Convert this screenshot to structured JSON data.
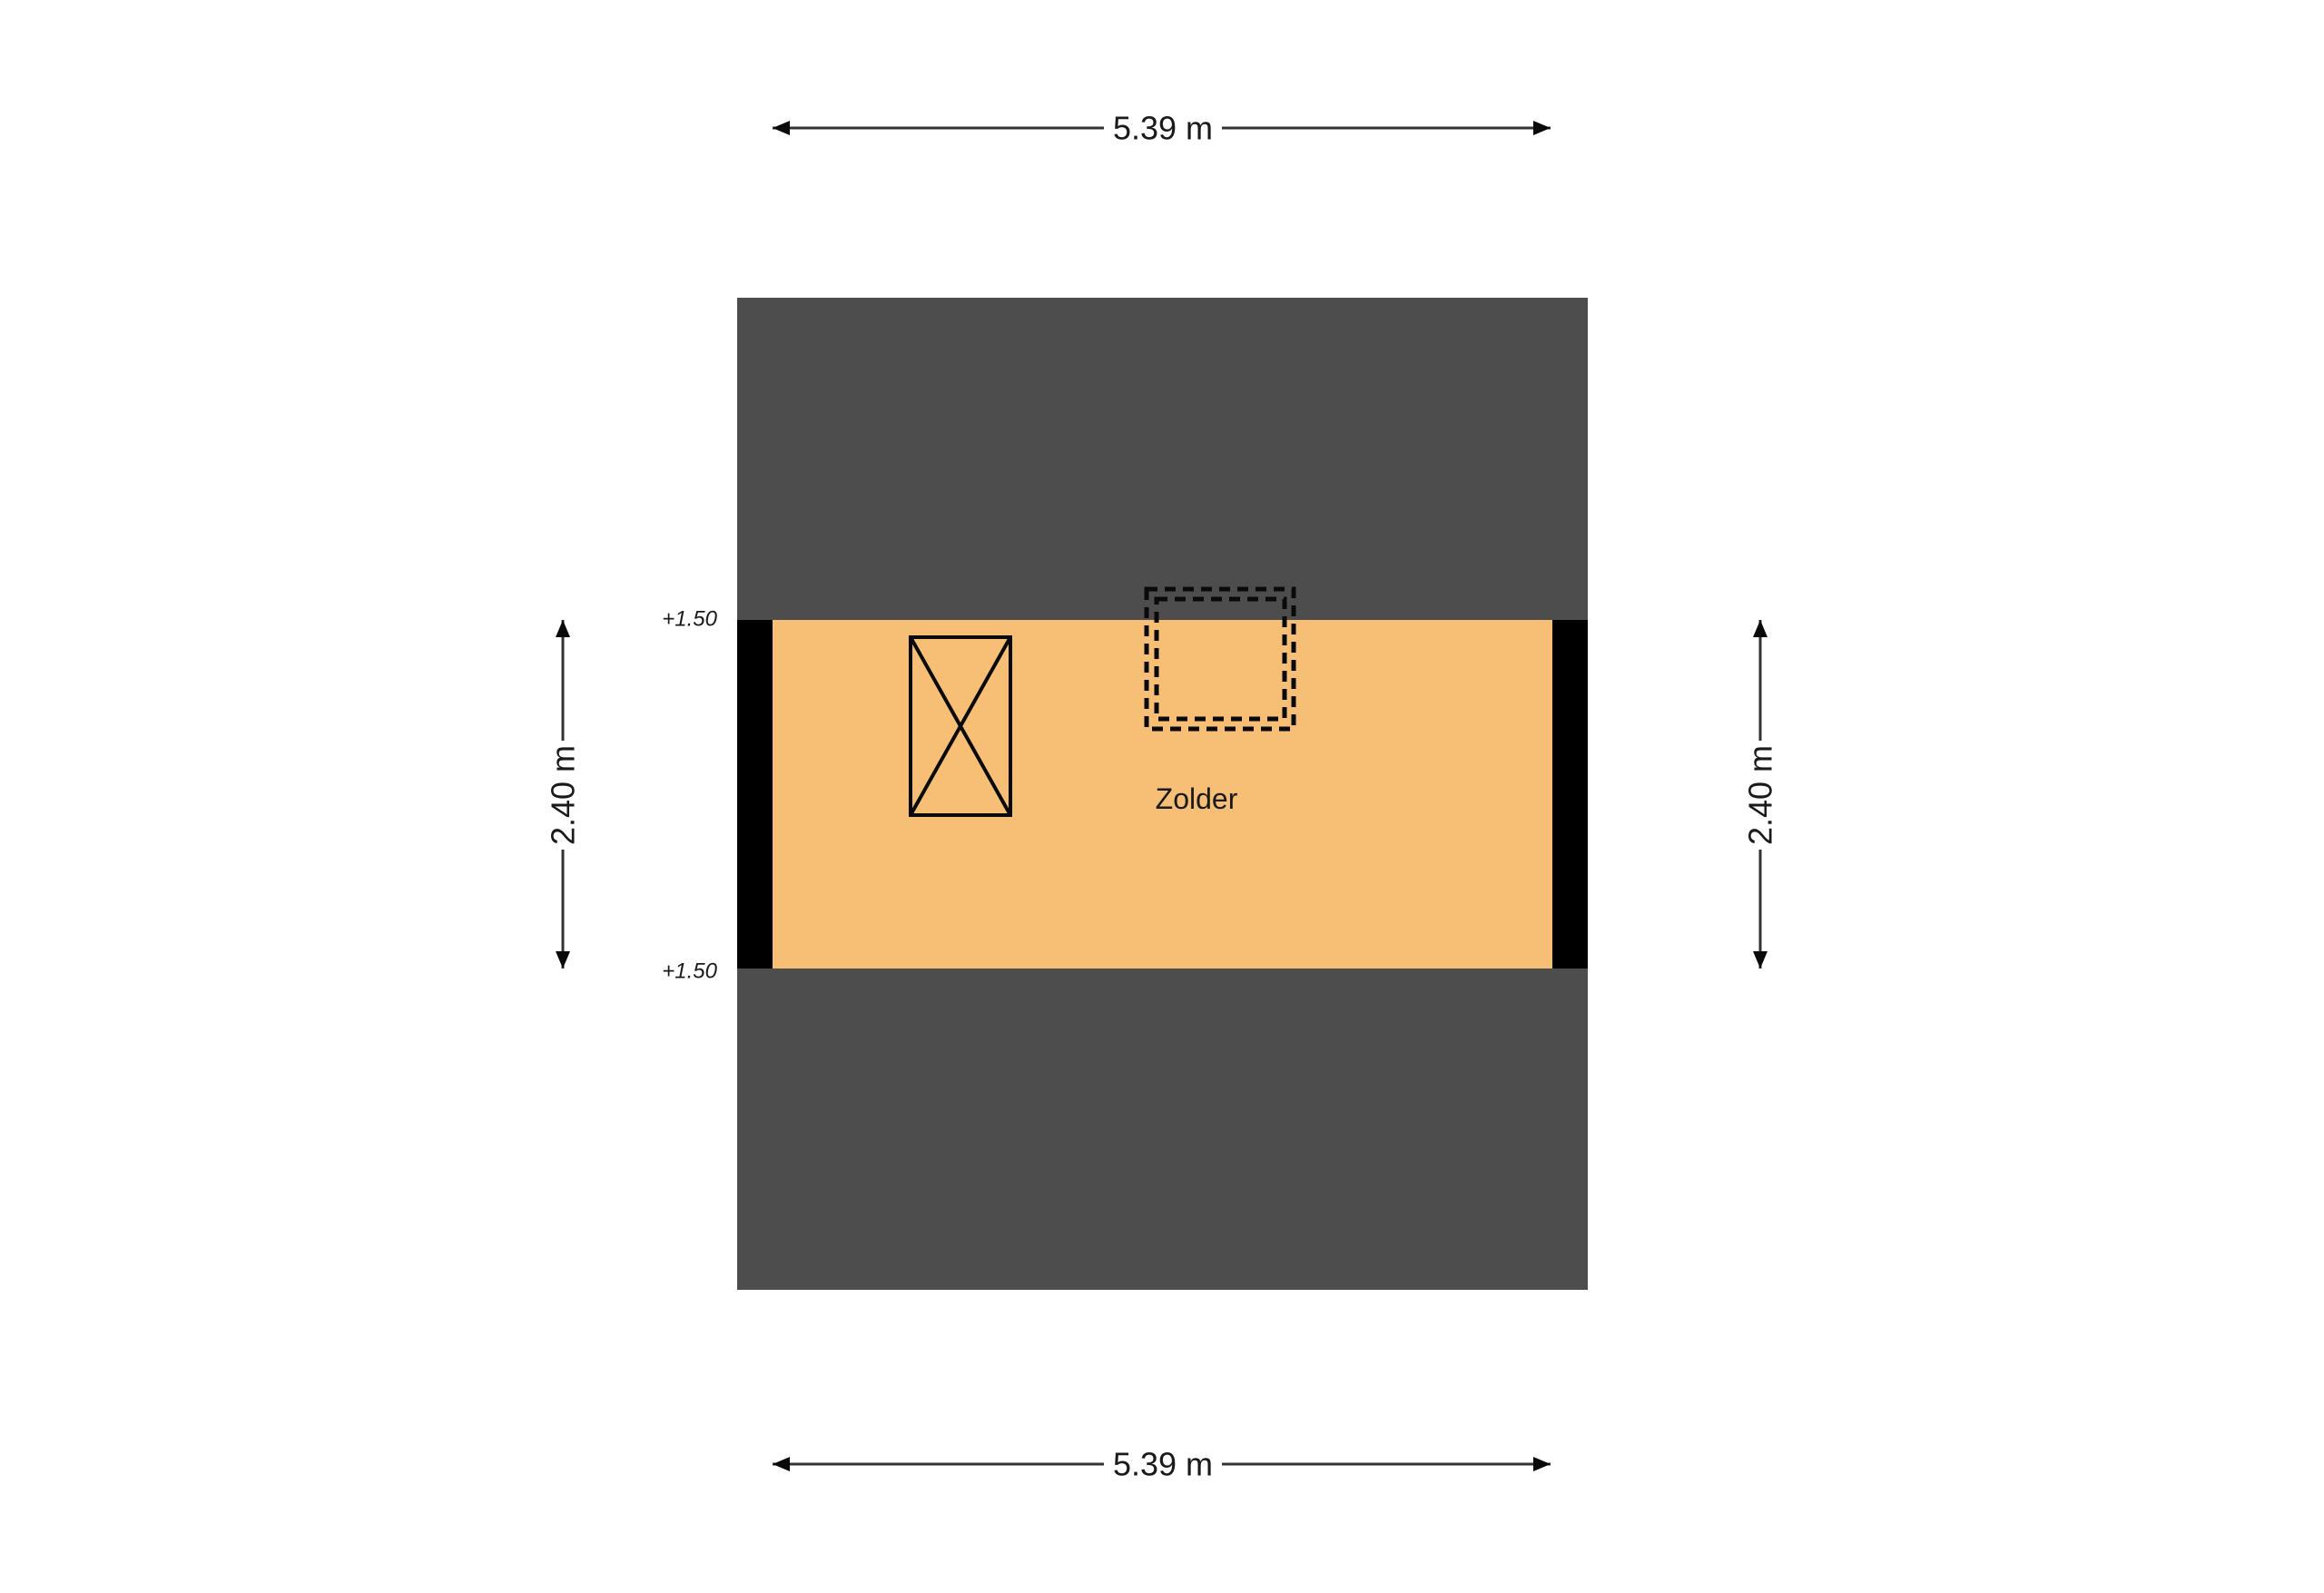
{
  "floorplan": {
    "room": {
      "label": "Zolder"
    },
    "dimensions": {
      "top": "5.39 m",
      "bottom": "5.39 m",
      "left": "2.40 m",
      "right": "2.40 m"
    },
    "levels": {
      "top": "+1.50",
      "bottom": "+1.50"
    },
    "symbols": {
      "stairs": "stairs-x-box-symbol",
      "roof_window": "roof-window-dashed-symbol"
    }
  },
  "colors": {
    "background": "#FFFFFF",
    "roof": "#4D4D4D",
    "floor": "#F7BF75",
    "wall": "#000000",
    "symbol_line": "#0A0A0A",
    "dimension_line": "#333333",
    "text": "#1A1A1A"
  }
}
